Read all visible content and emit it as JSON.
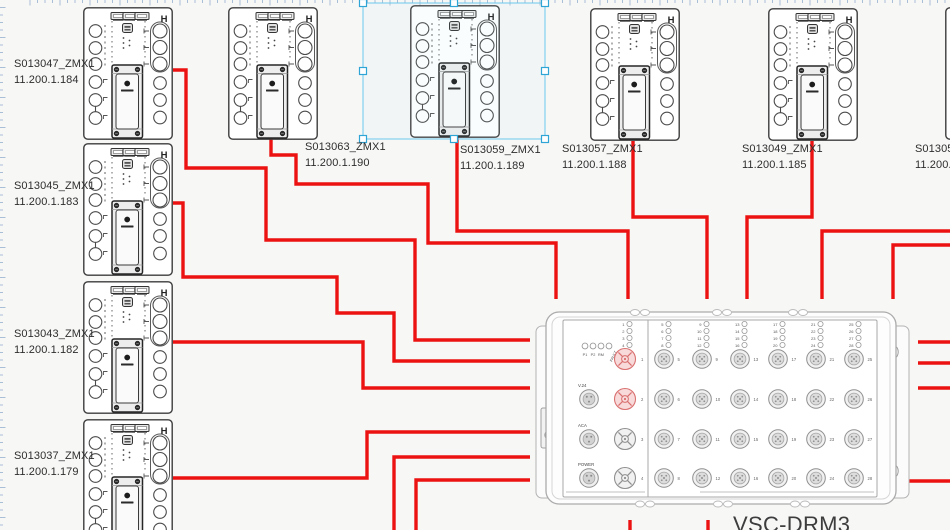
{
  "canvas": {
    "width": 950,
    "height": 530,
    "bg": "#f7f7f6"
  },
  "ruler": {
    "color": "#a9bfd8",
    "spacing": 7.5
  },
  "colors": {
    "wire": "#ec1212",
    "selection": "#69c8ee",
    "handle": "#2fa5d6",
    "device_line": "#3c3c3c",
    "vsc_line": "#a8a8a8",
    "port_gray": "#8f8f8f",
    "port_red": "#d97070",
    "port_red_fill": "#f8dada"
  },
  "zmx_devices": [
    {
      "name": "S013047_ZMX1",
      "ip": "11.200.1.184",
      "x": 83,
      "y": 7,
      "label": {
        "x": 14,
        "y": 57
      },
      "selected": false
    },
    {
      "name": "S013045_ZMX1",
      "ip": "11.200.1.183",
      "x": 83,
      "y": 143,
      "label": {
        "x": 14,
        "y": 179
      },
      "selected": false
    },
    {
      "name": "S013043_ZMX1",
      "ip": "11.200.1.182",
      "x": 83,
      "y": 281,
      "label": {
        "x": 14,
        "y": 327
      },
      "selected": false
    },
    {
      "name": "S013037_ZMX1",
      "ip": "11.200.1.179",
      "x": 83,
      "y": 419,
      "label": {
        "x": 14,
        "y": 449
      },
      "selected": false
    },
    {
      "name": "S013063_ZMX1",
      "ip": "11.200.1.190",
      "x": 228,
      "y": 7,
      "label": {
        "x": 305,
        "y": 140
      },
      "selected": false
    },
    {
      "name": "S013059_ZMX1",
      "ip": "11.200.1.189",
      "x": 410,
      "y": 5,
      "label": {
        "x": 460,
        "y": 143
      },
      "selected": true
    },
    {
      "name": "S013057_ZMX1",
      "ip": "11.200.1.188",
      "x": 590,
      "y": 8,
      "label": {
        "x": 562,
        "y": 142
      },
      "selected": false
    },
    {
      "name": "S013049_ZMX1",
      "ip": "11.200.1.185",
      "x": 768,
      "y": 8,
      "label": {
        "x": 742,
        "y": 142
      },
      "selected": false
    },
    {
      "name": "S013053",
      "ip": "11.200.1.",
      "x": 945,
      "y": 7,
      "label": {
        "x": 915,
        "y": 142
      },
      "selected": false
    }
  ],
  "selection": {
    "x": 363,
    "y": 3,
    "w": 182,
    "h": 136
  },
  "wires": [
    [
      [
        173,
        70
      ],
      [
        186,
        70
      ],
      [
        186,
        168
      ],
      [
        266,
        168
      ],
      [
        266,
        240
      ],
      [
        415,
        240
      ],
      [
        415,
        340
      ],
      [
        530,
        340
      ]
    ],
    [
      [
        173,
        203
      ],
      [
        183,
        203
      ],
      [
        183,
        277
      ],
      [
        337,
        277
      ],
      [
        337,
        313
      ],
      [
        394,
        313
      ],
      [
        394,
        361
      ],
      [
        530,
        361
      ]
    ],
    [
      [
        173,
        342
      ],
      [
        363,
        342
      ],
      [
        363,
        388
      ],
      [
        530,
        388
      ]
    ],
    [
      [
        173,
        478
      ],
      [
        367,
        478
      ],
      [
        367,
        432
      ],
      [
        530,
        432
      ]
    ],
    [
      [
        394,
        531
      ],
      [
        394,
        457
      ],
      [
        530,
        457
      ]
    ],
    [
      [
        416,
        531
      ],
      [
        416,
        480
      ],
      [
        530,
        480
      ]
    ],
    [
      [
        271,
        137
      ],
      [
        271,
        155
      ],
      [
        296,
        155
      ],
      [
        296,
        184
      ],
      [
        428,
        184
      ],
      [
        428,
        243
      ],
      [
        556,
        243
      ],
      [
        556,
        299
      ]
    ],
    [
      [
        457,
        136
      ],
      [
        457,
        231
      ],
      [
        628,
        231
      ],
      [
        628,
        299
      ]
    ],
    [
      [
        633,
        141
      ],
      [
        633,
        217
      ],
      [
        707,
        217
      ],
      [
        707,
        299
      ]
    ],
    [
      [
        812,
        141
      ],
      [
        812,
        217
      ],
      [
        747,
        217
      ],
      [
        747,
        299
      ]
    ],
    [
      [
        951,
        231
      ],
      [
        822,
        231
      ],
      [
        822,
        299
      ]
    ],
    [
      [
        951,
        245
      ],
      [
        893,
        245
      ],
      [
        893,
        299
      ]
    ],
    [
      [
        918,
        342
      ],
      [
        951,
        342
      ]
    ],
    [
      [
        918,
        363
      ],
      [
        951,
        363
      ]
    ],
    [
      [
        918,
        388
      ],
      [
        951,
        388
      ]
    ],
    [
      [
        900,
        481
      ],
      [
        951,
        481
      ]
    ],
    [
      [
        630,
        520
      ],
      [
        630,
        531
      ]
    ],
    [
      [
        708,
        520
      ],
      [
        708,
        531
      ]
    ]
  ],
  "vsc": {
    "x": 546,
    "y": 312,
    "w": 350,
    "h": 192,
    "label": "VSC-DRM3",
    "label_pos": {
      "x": 733,
      "y": 512
    },
    "status_leds": [
      "P1",
      "P2",
      "RM",
      "FAULT"
    ],
    "side_ports": [
      "V.24",
      "ACA",
      "POWER"
    ],
    "columns": [
      {
        "ports": [
          "1",
          "2",
          "3",
          "4"
        ]
      },
      {
        "ports": [
          "5",
          "6",
          "7",
          "8"
        ]
      },
      {
        "ports": [
          "9",
          "10",
          "11",
          "12"
        ]
      },
      {
        "ports": [
          "13",
          "14",
          "15",
          "16"
        ]
      },
      {
        "ports": [
          "17",
          "18",
          "19",
          "20"
        ]
      },
      {
        "ports": [
          "21",
          "22",
          "23",
          "24"
        ]
      },
      {
        "ports": [
          "25",
          "26",
          "27",
          "28"
        ]
      }
    ],
    "highlighted_ports": [
      "1",
      "2"
    ]
  }
}
